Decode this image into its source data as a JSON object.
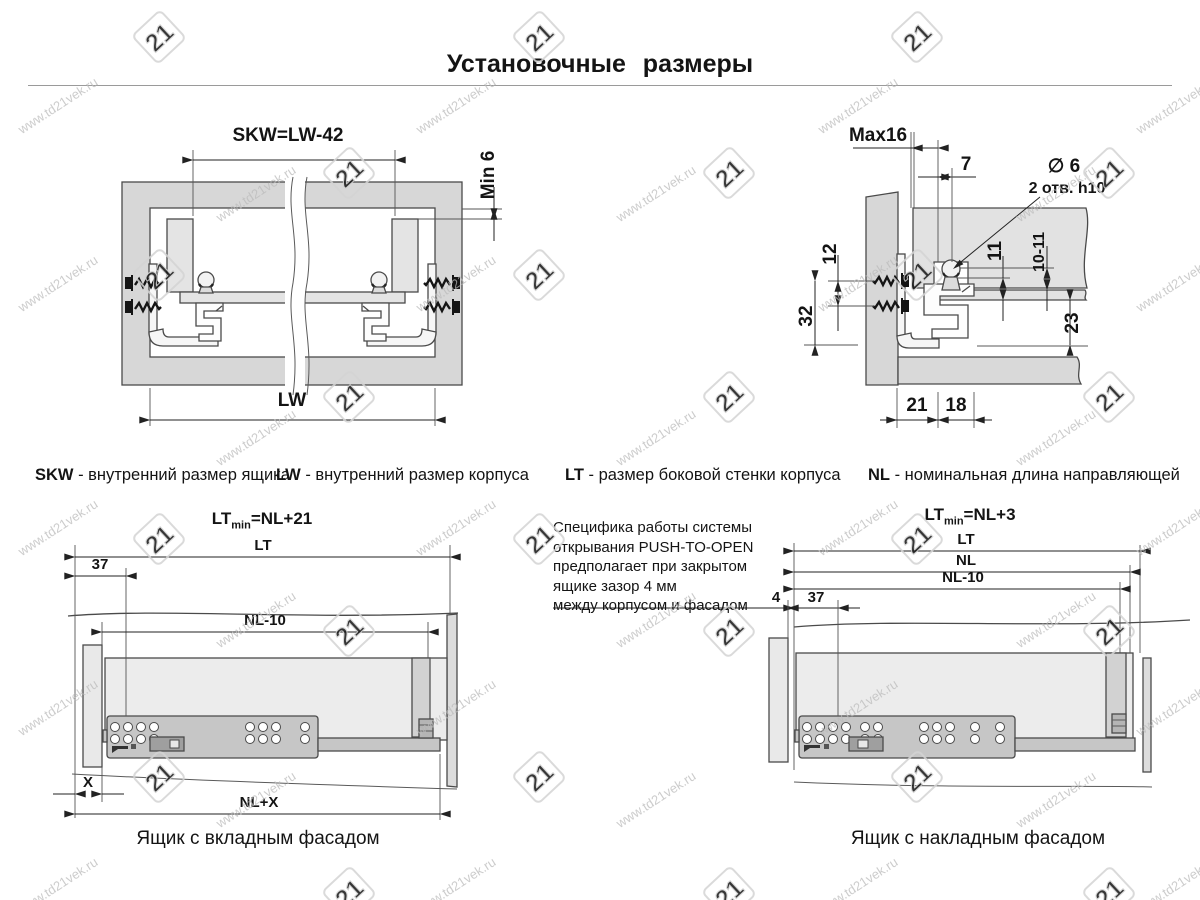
{
  "title": "Установочные размеры",
  "watermark": {
    "text": "www.td21vek.ru",
    "logo_text": "21"
  },
  "definitions": [
    {
      "term": "SKW",
      "desc": " - внутренний размер ящика"
    },
    {
      "term": "LW",
      "desc": " - внутренний размер корпуса"
    },
    {
      "term": "LT",
      "desc": " - размер боковой стенки корпуса"
    },
    {
      "term": "NL",
      "desc": " - номинальная длина направляющей"
    }
  ],
  "note": {
    "lines": [
      "Специфика работы системы",
      "открывания PUSH-TO-OPEN",
      "предполагает при закрытом",
      "ящике зазор 4 мм",
      "между корпусом и фасадом"
    ]
  },
  "top_left": {
    "dims": {
      "skw": "SKW=LW-42",
      "min6": "Min 6",
      "lw": "LW"
    }
  },
  "top_right": {
    "dims": {
      "max16": "Max16",
      "d7": "7",
      "dia": "∅ 6",
      "holes": "2 отв. h10",
      "d12": "12",
      "d32": "32",
      "d11": "11",
      "d10_11": "10-11",
      "d23": "23",
      "d21": "21",
      "d18": "18"
    }
  },
  "bottom_left": {
    "formula": {
      "base": "LT",
      "sub": "min",
      "rest": "=NL+21"
    },
    "dims": {
      "lt": "LT",
      "d37": "37",
      "nl10": "NL-10",
      "x": "X",
      "nlx": "NL+X"
    },
    "caption": "Ящик с вкладным фасадом"
  },
  "bottom_right": {
    "formula": {
      "base": "LT",
      "sub": "min",
      "rest": "=NL+3"
    },
    "dims": {
      "lt": "LT",
      "nl": "NL",
      "nl10": "NL-10",
      "d4": "4",
      "d37": "37"
    },
    "caption": "Ящик с накладным фасадом"
  }
}
